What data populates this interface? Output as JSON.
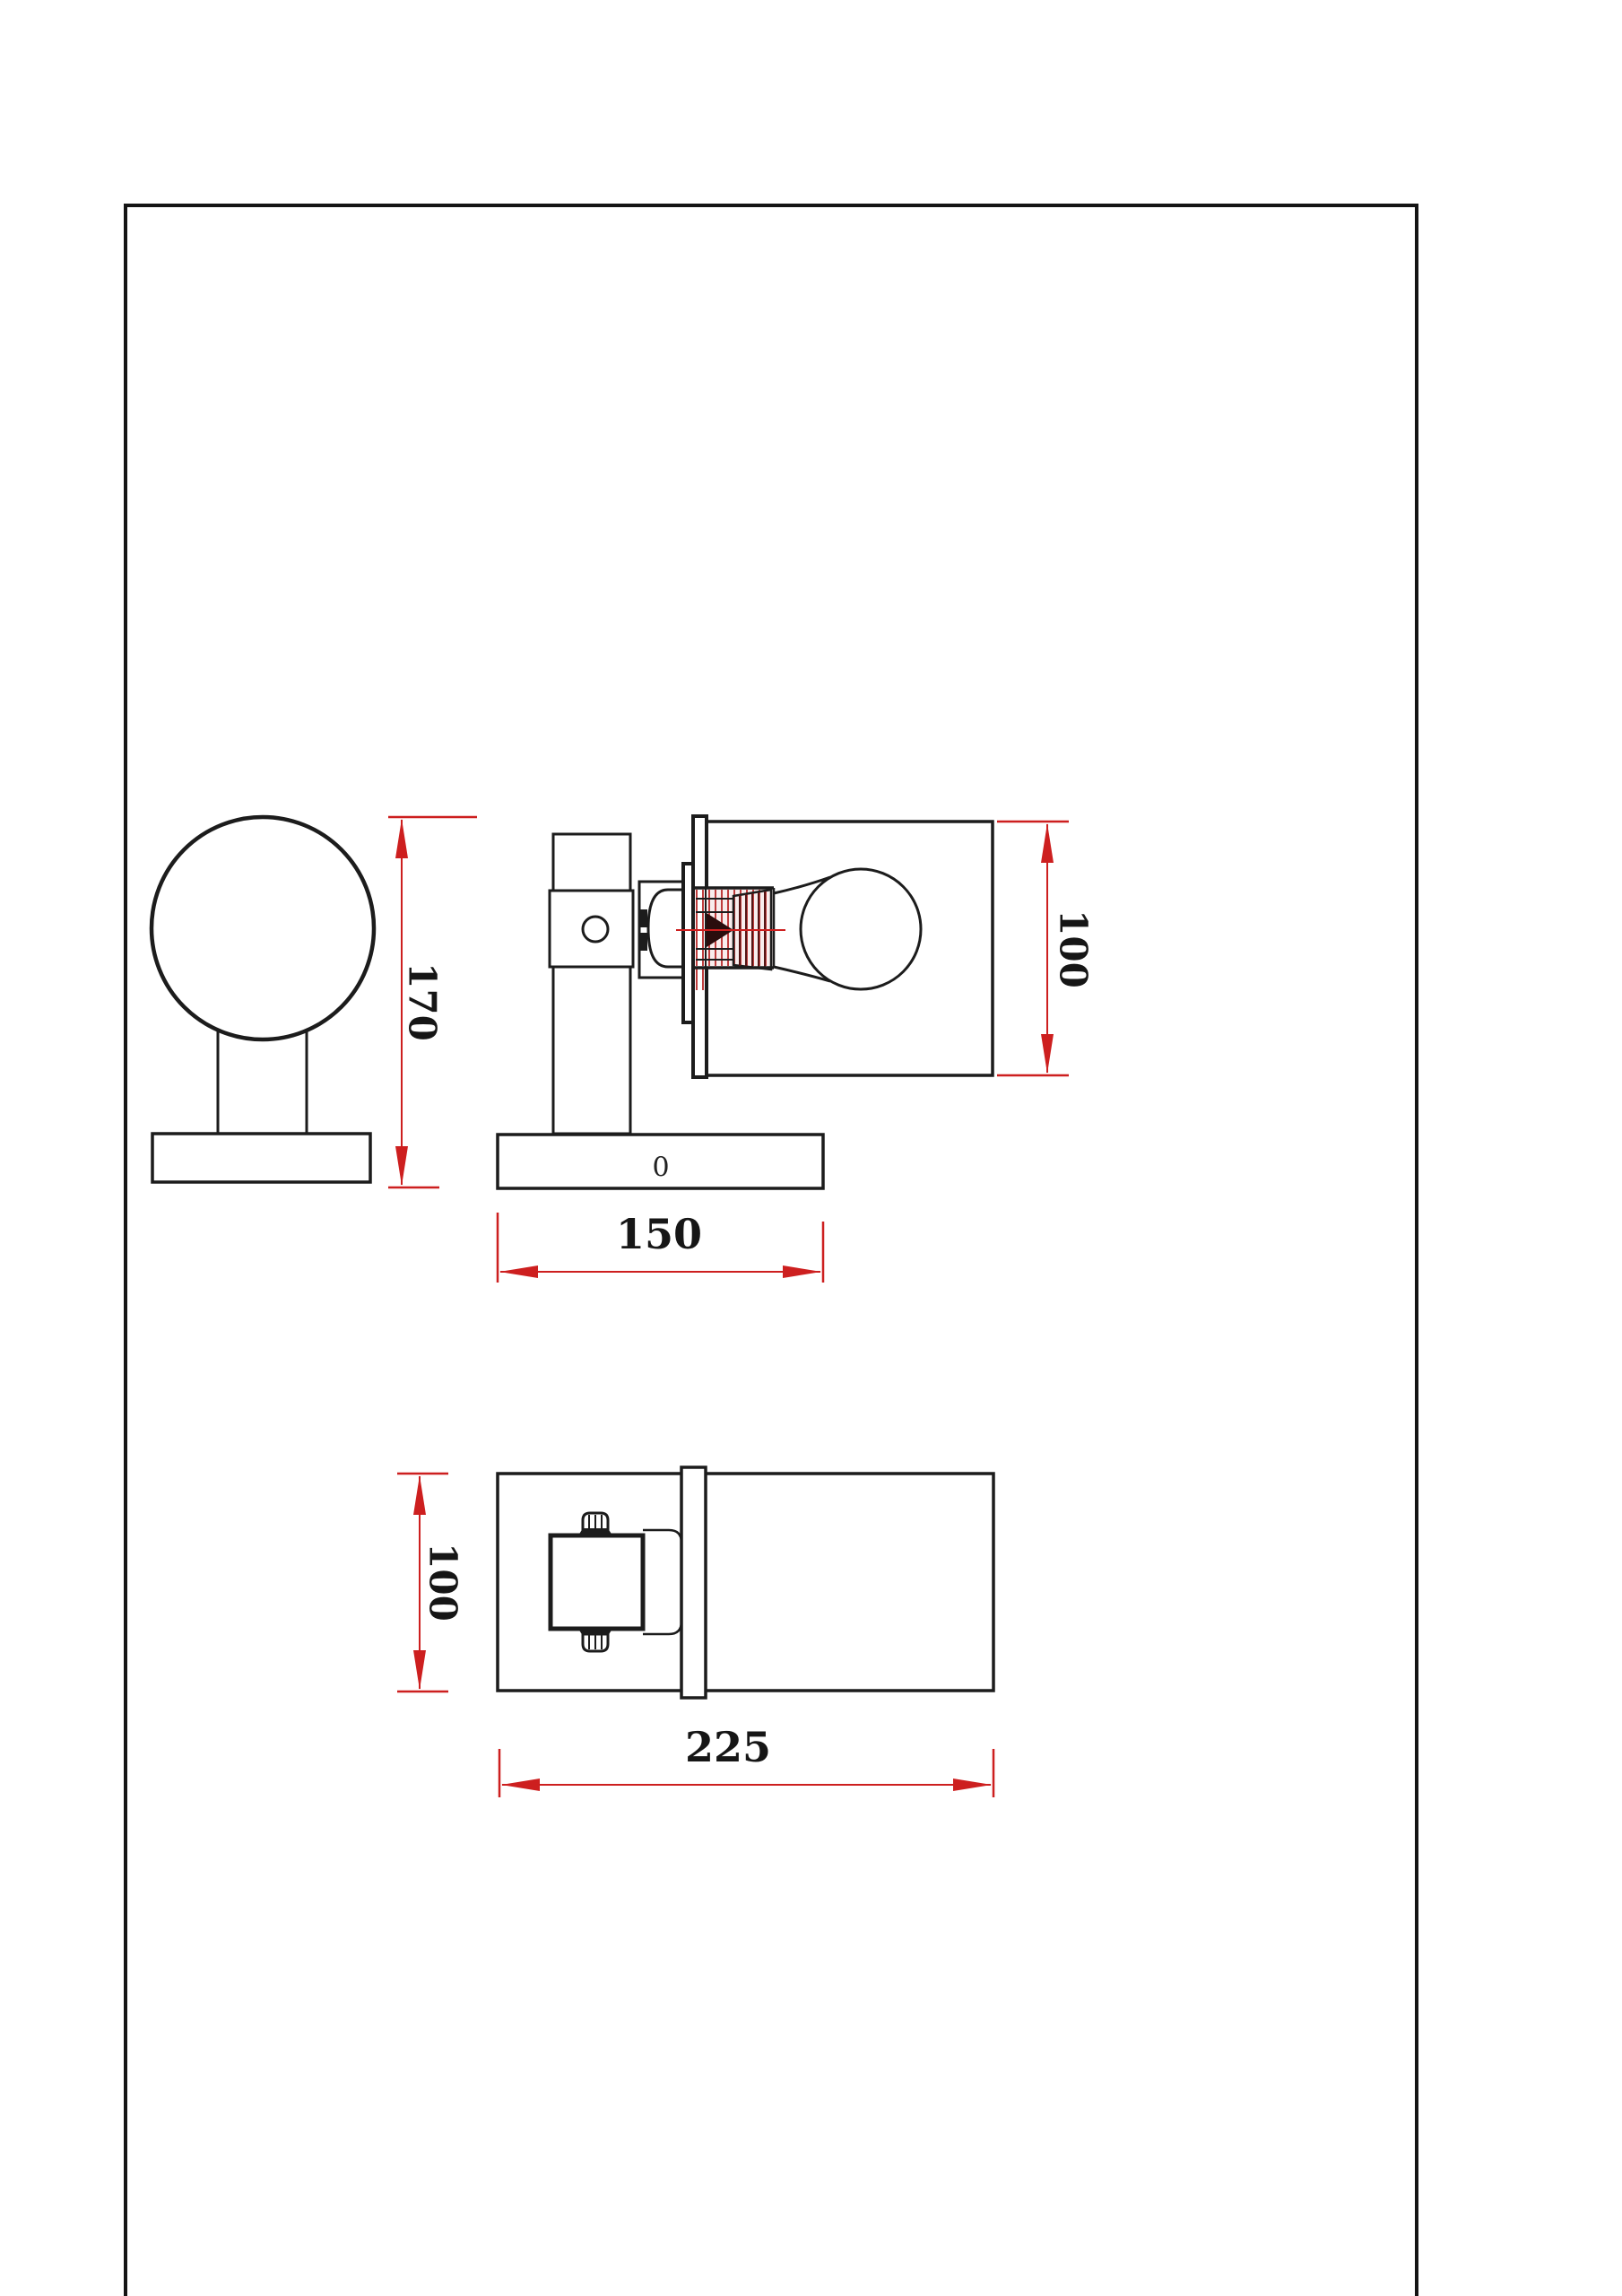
{
  "document": {
    "type": "technical-drawing",
    "background": "#ffffff",
    "frame_color": "#141414"
  },
  "drawing": {
    "line_color": "#1c1c1c",
    "dimension_color": "#cd1f1f",
    "hatch_color": "#bf3d3d",
    "labels": {
      "overall_height": "170",
      "shade_diameter": "100",
      "base_length": "150",
      "body_width": "100",
      "overall_length": "225",
      "base_marking": "0"
    }
  }
}
